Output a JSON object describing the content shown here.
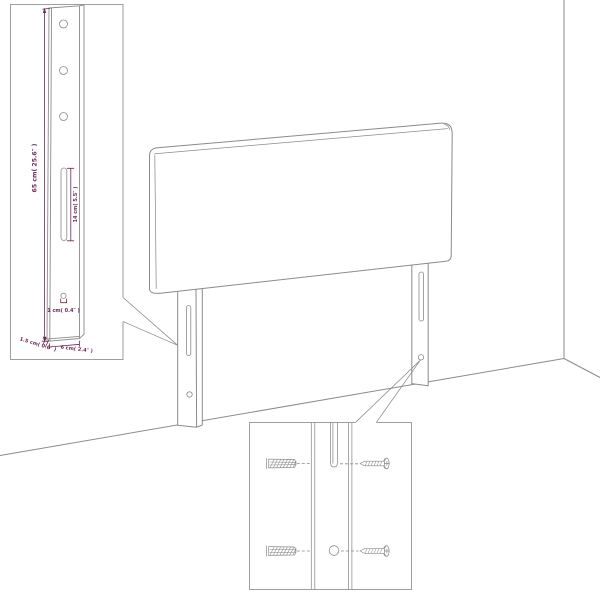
{
  "diagram": {
    "dimension_labels": {
      "leg_height": "65 cm( 25.6″ )",
      "slot_length": "14 cm( 5.5″ )",
      "hole_diameter": "1 cm( 0.4″ )",
      "leg_depth": "1.5 cm( 0.6″ )",
      "leg_width": "6 cm( 2.4″ )"
    },
    "icons": {
      "wall_plug": "wall-plug-icon",
      "screw": "screw-icon"
    },
    "colors": {
      "outline": "#8b8b8b",
      "inset_border": "#9e9e9e",
      "dimension": "#6f2a57",
      "background": "#ffffff"
    }
  }
}
